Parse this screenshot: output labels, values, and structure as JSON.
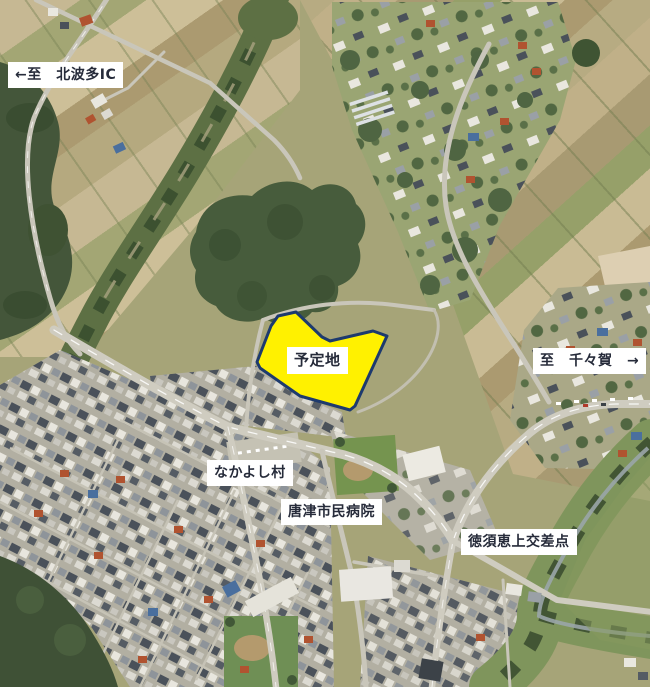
{
  "map": {
    "kind": "annotated-aerial-photo",
    "labels": {
      "kitahata": "←至　北波多IC",
      "site": "予定地",
      "chichiga": "至　千々賀　→",
      "nakayoshi": "なかよし村",
      "hospital": "唐津市民病院",
      "intersection": "徳須恵上交差点"
    },
    "colors": {
      "site_fill": "#FFF100",
      "site_border": "#1D3A6E",
      "label_bg": "#FFFFFF",
      "label_text": "#262B3A"
    }
  }
}
